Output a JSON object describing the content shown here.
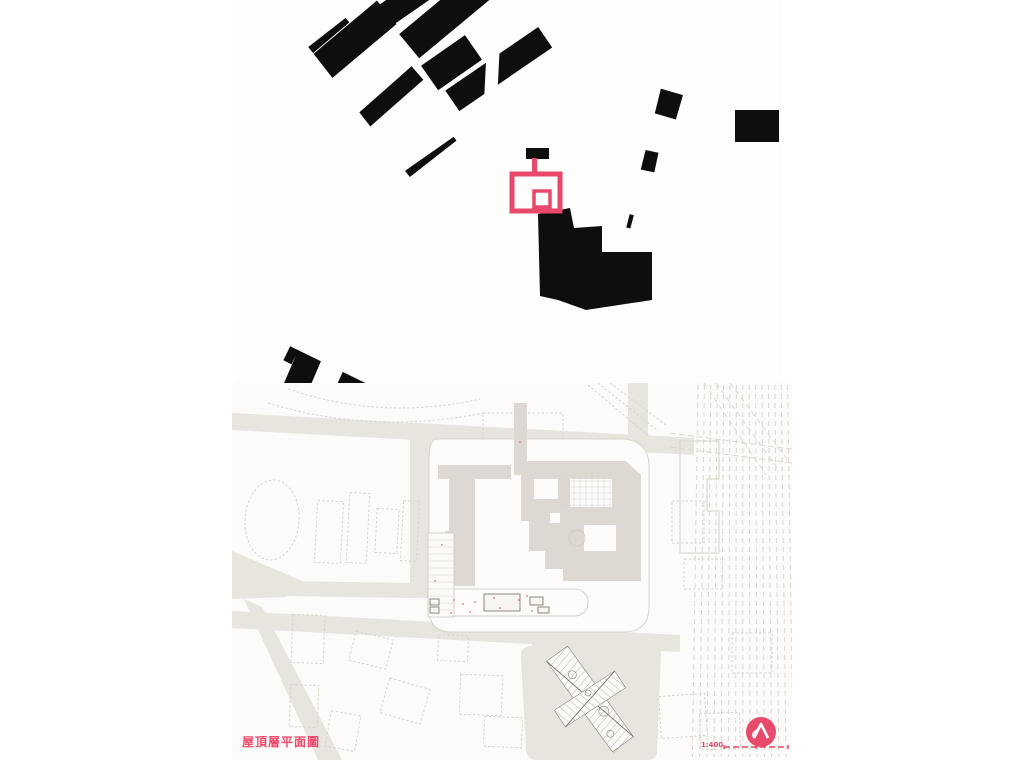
{
  "page": {
    "width": 1024,
    "height": 768,
    "background": "#ffffff"
  },
  "map_panel": {
    "label": "city figure-ground map",
    "x": 238,
    "y": 0,
    "w": 545,
    "h": 383,
    "background": "#fdfdfb",
    "building_color": "#100e0c",
    "highlight": {
      "label": "site building highlighted outline",
      "color": "#e8486b",
      "outer": [
        274,
        174,
        48,
        37
      ],
      "inner": [
        296,
        191,
        16,
        16
      ],
      "stem": [
        294,
        158,
        5,
        18
      ],
      "cap": [
        288,
        148,
        23,
        11
      ]
    },
    "zones": [
      {
        "seed": 11,
        "x": -15,
        "y": -25,
        "w": 225,
        "h": 165,
        "a": -38,
        "cw": 95,
        "ch": 26,
        "gx": 16,
        "gy": 10,
        "skip": 0.28
      },
      {
        "seed": 22,
        "x": 165,
        "y": -15,
        "w": 190,
        "h": 150,
        "a": 14,
        "cw": 38,
        "ch": 24,
        "gx": 9,
        "gy": 8,
        "skip": 0.42
      },
      {
        "seed": 33,
        "x": 345,
        "y": -15,
        "w": 210,
        "h": 125,
        "a": 1,
        "cw": 44,
        "ch": 24,
        "gx": 12,
        "gy": 11,
        "skip": 0.5
      },
      {
        "seed": 44,
        "x": -20,
        "y": 108,
        "w": 275,
        "h": 300,
        "a": 26,
        "cw": 46,
        "ch": 34,
        "gx": 6,
        "gy": 6,
        "skip": 0.1
      },
      {
        "seed": 55,
        "x": 195,
        "y": 145,
        "w": 165,
        "h": 245,
        "a": 26,
        "cw": 40,
        "ch": 28,
        "gx": 7,
        "gy": 7,
        "skip": 0.2
      },
      {
        "seed": 66,
        "x": 345,
        "y": 92,
        "w": 215,
        "h": 300,
        "a": 7,
        "cw": 40,
        "ch": 26,
        "gx": 10,
        "gy": 9,
        "skip": 0.34
      }
    ],
    "streets": [
      [
        258,
        -8,
        250,
        152,
        13
      ],
      [
        -15,
        195,
        365,
        383,
        10
      ],
      [
        40,
        105,
        305,
        320,
        7
      ],
      [
        362,
        55,
        356,
        390,
        9
      ],
      [
        468,
        95,
        462,
        390,
        8
      ],
      [
        150,
        250,
        360,
        170,
        6
      ]
    ],
    "plaza_void": "232,118 352,132 346,238 246,230",
    "station_points": "300,214 332,208 336,228 364,226 364,252 414,252 414,300 348,310 320,300 302,296",
    "blocks": [
      [
        497,
        110,
        44,
        32
      ]
    ]
  },
  "plan_panel": {
    "label": "roof level site plan drawing",
    "x": 232,
    "y": 383,
    "w": 560,
    "h": 377,
    "background": "#fcfbf9",
    "road_color": "#e8e4de",
    "mass_color": "#ddd9d2",
    "line_color": "#d8d3cc",
    "detail_color": "#827b70",
    "accent_color": "#e8486b",
    "title": "屋頂層平面圖",
    "title_color": "#ee4a6d",
    "scale_label": "1:400",
    "logo_icon": "circle-triangle-logo",
    "roads": [
      "0,30 462,55 462,72 0,47",
      "178,45 200,46 200,212 178,210",
      "0,197 292,202 292,217 0,212",
      "0,228 448,252 448,269 0,245",
      "12,216 30,224 110,377 86,377",
      "297,216 320,217 334,377 308,377",
      "396,0 416,0 416,62 396,64",
      "0,168 70,198 54,214 0,216"
    ],
    "railway": {
      "x0": 466,
      "count": 15,
      "dx": 6.4,
      "y0": 2,
      "y1": 374,
      "dash": "5,4",
      "color": "#dcd7d0",
      "diagonals": [
        [
          472,
          0,
          534,
          92
        ],
        [
          484,
          0,
          546,
          86
        ],
        [
          498,
          0,
          558,
          80
        ]
      ],
      "crossing": [
        [
          438,
          50,
          560,
          66
        ],
        [
          438,
          64,
          560,
          80
        ]
      ]
    },
    "building": {
      "site_path": "M204,56 H392 Q416,58 417,82 V224 Q417,248 393,249 H218 Q197,248 197,226 V78 Q197,58 204,56 Z",
      "bridge": [
        282,
        20,
        13,
        72
      ],
      "masses": [
        "206,82 279,82 279,96 206,96",
        "289,78 394,78 409,92 409,198 331,198 331,186 313,186 313,168 297,168 297,138 289,138",
        "217,96 243,96 243,203 207,203 207,178 213,178 213,148 217,148"
      ],
      "cutouts": [
        [
          302,
          96,
          24,
          20
        ],
        [
          338,
          96,
          42,
          28
        ],
        [
          352,
          142,
          32,
          26
        ],
        [
          318,
          130,
          10,
          10
        ]
      ],
      "roof_grid": [
        330,
        86,
        54,
        38,
        6
      ],
      "plaza": [
        208,
        206,
        148,
        27
      ],
      "inner_buildings": [
        [
          252,
          211,
          36,
          17
        ],
        [
          298,
          214,
          13,
          8
        ],
        [
          306,
          224,
          11,
          6
        ]
      ],
      "rooms_strip": [
        196,
        150,
        26,
        84
      ],
      "courtyard_circle": [
        345,
        155,
        8
      ],
      "annex": "448,58 487,58 487,96 475,96 475,128 487,128 487,170 448,170 448,58"
    },
    "garden": {
      "block_path": "M300,263 L420,261 Q429,261 429,271 L425,368 Q425,377 415,377 L305,377 Q295,377 294,367 L289,274 Q288,263 300,263 Z",
      "cx": 358,
      "cy": 316,
      "angle": -36,
      "barA": [
        -13,
        -56,
        26,
        112
      ],
      "barB": [
        -10,
        -36,
        20,
        72
      ],
      "circles": [
        [
          0,
          -30,
          4
        ],
        [
          4,
          18,
          5
        ],
        [
          -4,
          40,
          3.5
        ],
        [
          2,
          -6,
          3
        ]
      ]
    },
    "outlines": [
      [
        84,
        118,
        26,
        62,
        3
      ],
      [
        116,
        110,
        20,
        70,
        3
      ],
      [
        144,
        126,
        22,
        44,
        3
      ],
      [
        170,
        118,
        16,
        60,
        3
      ],
      [
        60,
        232,
        32,
        48,
        2
      ],
      [
        120,
        252,
        38,
        30,
        14
      ],
      [
        152,
        300,
        42,
        36,
        16
      ],
      [
        58,
        302,
        28,
        42,
        2
      ],
      [
        96,
        330,
        30,
        36,
        10
      ],
      [
        228,
        292,
        42,
        40,
        2
      ],
      [
        252,
        334,
        38,
        30,
        2
      ],
      [
        206,
        252,
        30,
        26,
        2
      ],
      [
        376,
        300,
        42,
        46,
        -5
      ],
      [
        428,
        312,
        46,
        42,
        -4
      ],
      [
        468,
        330,
        40,
        36,
        -2
      ],
      [
        440,
        118,
        32,
        42,
        0
      ],
      [
        452,
        176,
        38,
        30,
        0
      ],
      [
        500,
        250,
        40,
        40,
        0
      ],
      [
        251,
        30,
        80,
        30,
        0
      ]
    ],
    "track_oval": [
      40,
      137,
      27,
      40,
      4
    ],
    "arcs": [
      "M56,6 Q150,38 248,16",
      "M36,20 Q140,52 252,30"
    ],
    "diagonals": [
      [
        356,
        2,
        418,
        54
      ],
      [
        366,
        0,
        426,
        48
      ],
      [
        378,
        0,
        434,
        42
      ]
    ],
    "red_dots": [
      [
        288,
        59
      ],
      [
        222,
        217
      ],
      [
        231,
        221
      ],
      [
        243,
        219
      ],
      [
        262,
        215
      ],
      [
        287,
        217
      ],
      [
        295,
        213
      ],
      [
        238,
        229
      ],
      [
        268,
        225
      ],
      [
        210,
        162
      ],
      [
        203,
        198
      ],
      [
        219,
        230
      ],
      [
        300,
        228
      ]
    ],
    "scalebar": {
      "x1": 492,
      "x2": 556,
      "y": 364,
      "dash": "6,3"
    }
  }
}
